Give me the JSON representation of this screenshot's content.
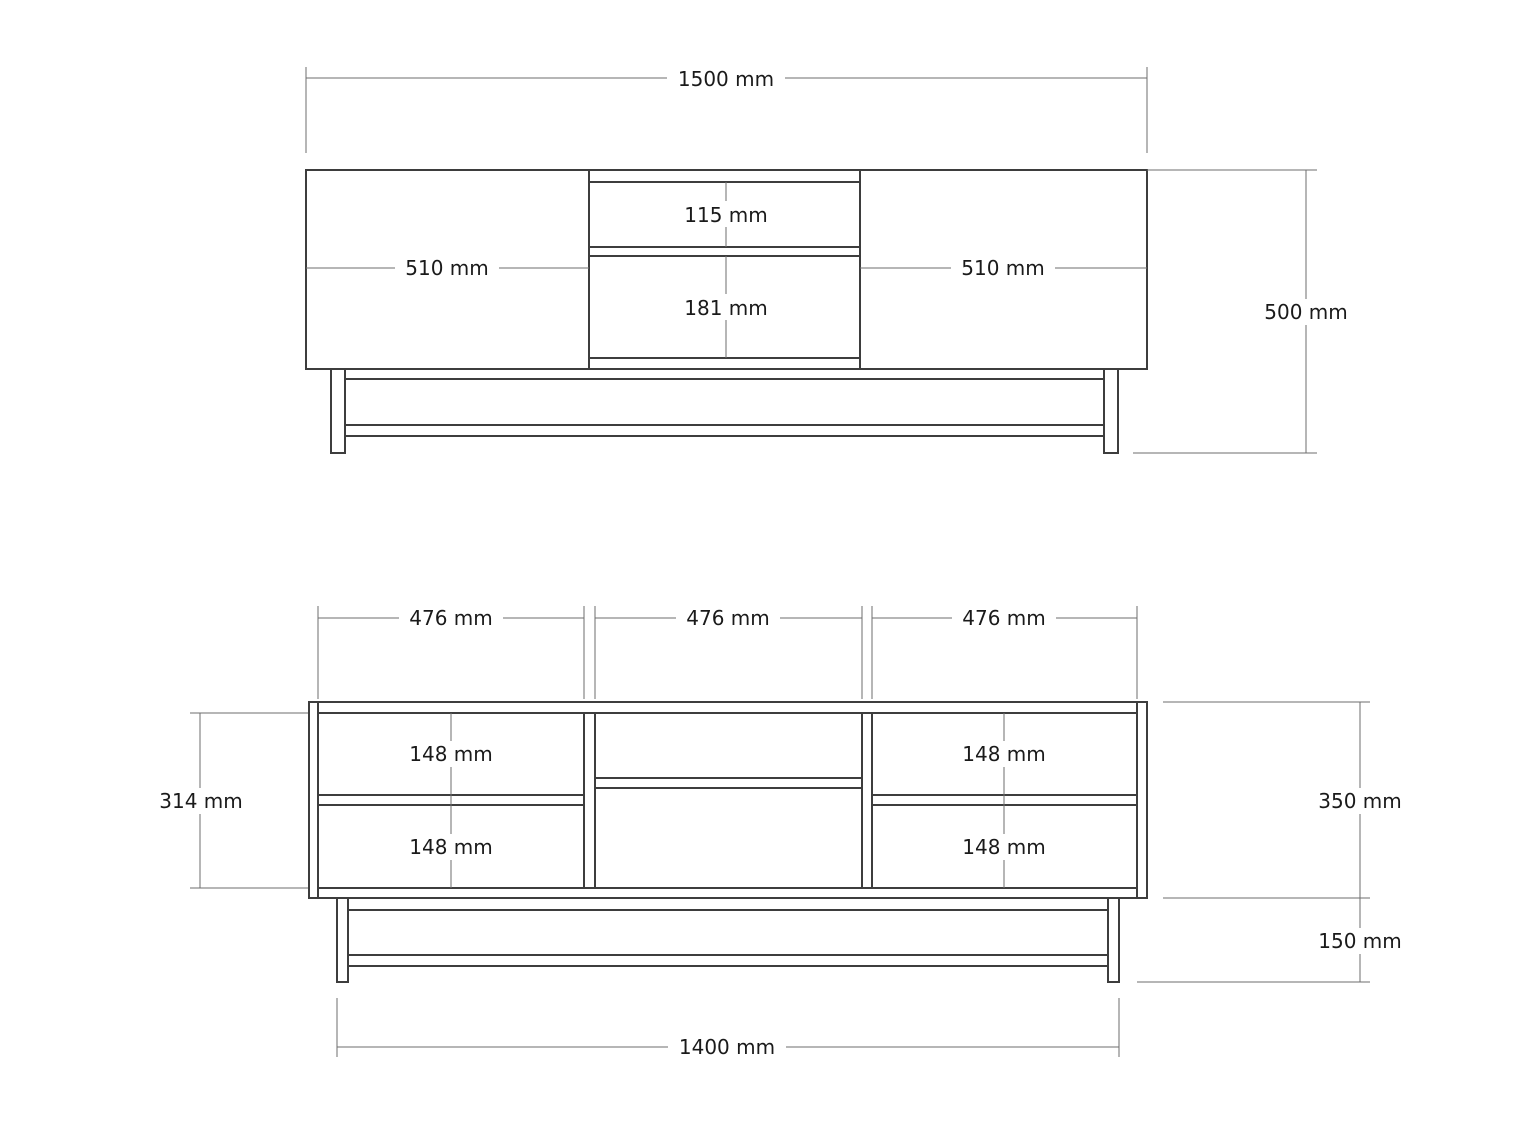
{
  "colors": {
    "line": "#3d3d3d",
    "dimension": "#6e6e6e",
    "text": "#1a1a1a",
    "background": "#ffffff"
  },
  "unit": "mm",
  "front_view": {
    "overall_width_label": "1500 mm",
    "overall_height_label": "500 mm",
    "left_door_width_label": "510 mm",
    "right_door_width_label": "510 mm",
    "top_drawer_height_label": "115 mm",
    "bottom_drawer_height_label": "181 mm"
  },
  "interior_view": {
    "compartment_width_labels": [
      "476 mm",
      "476 mm",
      "476 mm"
    ],
    "cubby_height_labels": [
      "148 mm",
      "148 mm",
      "148 mm",
      "148 mm"
    ],
    "interior_height_label": "314 mm",
    "carcass_height_label": "350 mm",
    "leg_height_label": "150 mm",
    "base_width_label": "1400 mm"
  }
}
